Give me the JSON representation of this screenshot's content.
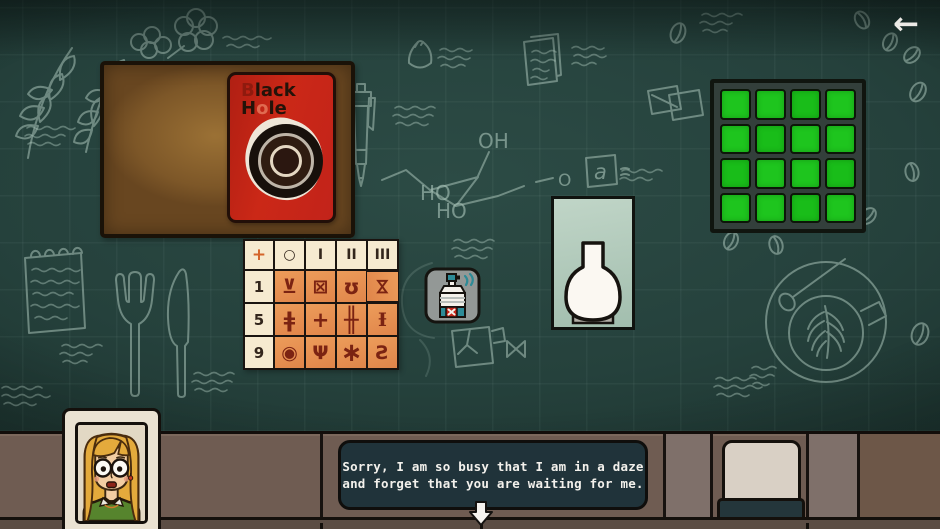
{
  "screen": {
    "back_icon": "←"
  },
  "card": {
    "b": "B",
    "lack": "lack",
    "h": "H",
    "o": "o",
    "le": "le"
  },
  "chalk": {
    "oh": "OH",
    "ho1": "HO",
    "ho2": "HO",
    "o": "O",
    "a": "a"
  },
  "symbol_table": {
    "corner": "+",
    "headers": [
      "○",
      "I",
      "II",
      "III"
    ],
    "rows": [
      {
        "num": "1",
        "c1": "⊻",
        "c2": "⊠",
        "c3": "ʊ",
        "c4": "⋈"
      },
      {
        "num": "5",
        "c1": "ǂ",
        "c2": "+",
        "c3": "╫",
        "c4": "Ɨ"
      },
      {
        "num": "9",
        "c1": "◉",
        "c2": "Ψ",
        "c3": "∗",
        "c4": "Ƨ"
      }
    ]
  },
  "grid_panel": {
    "rows": 4,
    "cols": 4,
    "lit_cells": 16,
    "lit_color": "#1ec51e"
  },
  "dialogue": {
    "line1": "Sorry, I am so busy that I am in a daze",
    "line2": "and forget that you are waiting for me."
  },
  "colors": {
    "chalkboard": "#24423d",
    "chalk": "#a9c4b9",
    "board_brown": "#8a6433",
    "card_red": "#c9271a",
    "table_orange": "#e58d4d",
    "table_cream": "#f6ead0",
    "symbol_ink": "#7b2312",
    "grid_green": "#1ec51e",
    "counter": "#6f5c52",
    "spray_teal": "#2d8b97",
    "alert_red": "#c22418",
    "dialogue_bg": "#20333a"
  }
}
